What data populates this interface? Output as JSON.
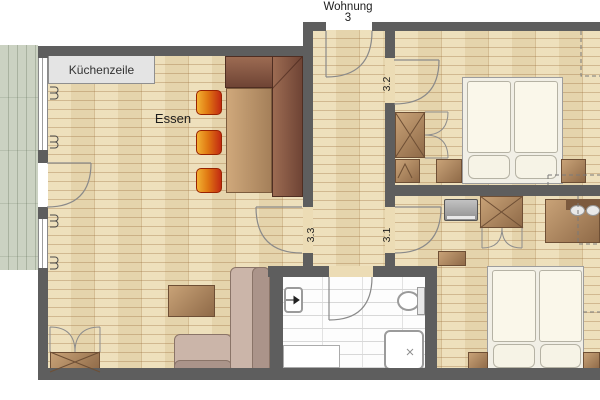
{
  "plan": {
    "apartment": {
      "line1": "Wohnung",
      "line2": "3"
    },
    "kitchen_label": "Küchenzeile",
    "dining_label": "Essen",
    "rooms": [
      {
        "number": "3.2"
      },
      {
        "number": "3.3"
      },
      {
        "number": "3.1"
      }
    ],
    "colors": {
      "wall": "#5e5e5e",
      "parquet_floor": "#ecdcb5",
      "terrace_deck": "#cbd2c2",
      "bathroom_tile": "#fdfdfd",
      "kitchen_counter": "#e4e4e4",
      "dining_bench": "#8a5a45",
      "dining_table": "#c19b70",
      "chair_orange": "#e8851a",
      "chair_red": "#c52f12",
      "sofa": "#c3ada1",
      "wood_furniture": "#a87c58",
      "bed_linen": "#f6f3e8",
      "door_arc": "#8a8a8a"
    }
  }
}
